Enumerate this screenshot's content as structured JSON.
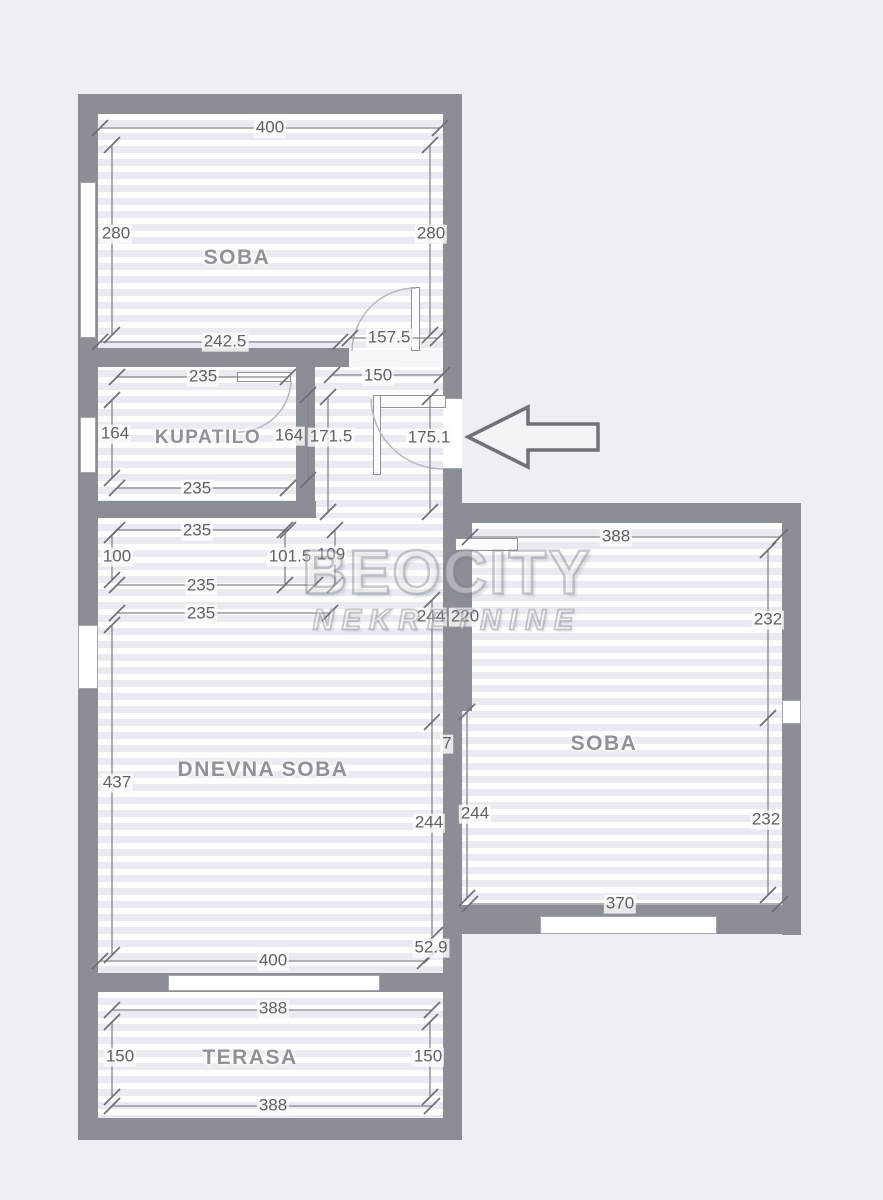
{
  "watermark": {
    "line1": "BEOCITY",
    "line2": "NEKRETNINE"
  },
  "rooms": {
    "soba_top": "SOBA",
    "kupatilo": "KUPATILO",
    "dnevna": "DNEVNA SOBA",
    "soba_right": "SOBA",
    "terasa": "TERASA"
  },
  "dims": {
    "s1_top": "400",
    "s1_left": "280",
    "s1_right": "280",
    "s1_bot_left": "242.5",
    "s1_bot_right": "157.5",
    "kup_top": "235",
    "hall_top": "150",
    "kup_left": "164",
    "kup_right": "164",
    "hall_w_left": "171.5",
    "hall_w_right": "175.1",
    "kup_bot_a": "235",
    "kup_bot_b": "235",
    "pass_left": "100",
    "pass_mid_a": "101.5",
    "pass_mid_b": "109",
    "pass_bot_a": "235",
    "pass_bot_b": "235",
    "corr_top_a": "244",
    "corr_top_b": "220",
    "corr_mid": "7",
    "corr_low_a": "244",
    "corr_low_b": "244",
    "dn_left": "437",
    "dn_bot": "400",
    "dn_gap": "52.9",
    "r_top": "388",
    "r_right_a": "232",
    "r_right_b": "232",
    "r_bot": "370",
    "t_top": "388",
    "t_left": "150",
    "t_right": "150",
    "t_bot": "388"
  },
  "colors": {
    "wall": "#8b8e95",
    "background": "#edeff4",
    "dimension_line": "#83868c",
    "label_text": "#5e6167",
    "watermark": "#8a8d94"
  }
}
